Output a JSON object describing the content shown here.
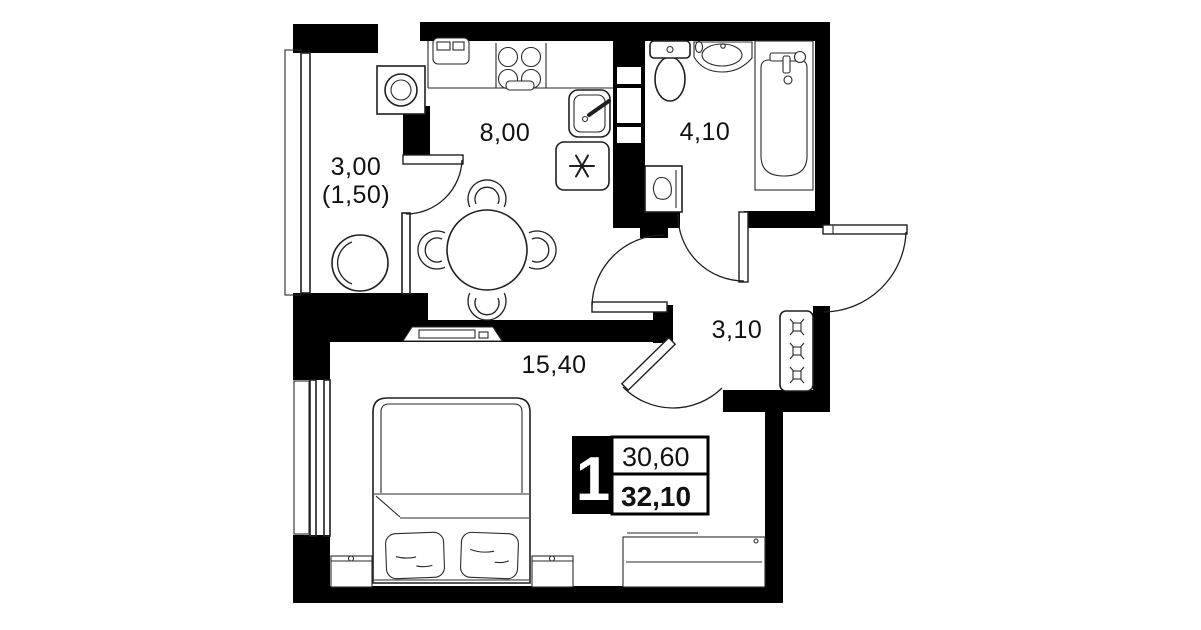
{
  "title": "apartment-floor-plan",
  "colors": {
    "wall": "#000000",
    "line": "#1f1f1f",
    "background": "#ffffff",
    "text": "#111111",
    "badge_bg": "#000000",
    "badge_text": "#ffffff"
  },
  "rooms": {
    "balcony": {
      "label_area": "3,00",
      "label_area_secondary": "(1,50)"
    },
    "kitchen": {
      "label_area": "8,00"
    },
    "bathroom": {
      "label_area": "4,10"
    },
    "hallway": {
      "label_area": "3,10"
    },
    "living_room": {
      "label_area": "15,40"
    }
  },
  "info_badge": {
    "room_count": "1",
    "living_area": "30,60",
    "total_area": "32,10"
  },
  "furniture_icons": [
    "washing-machine-icon",
    "balcony-chair-icon",
    "kitchen-appliance-icon",
    "cooktop-icon",
    "kitchen-sink-icon",
    "fridge-icon",
    "dining-table-icon",
    "chair-icon",
    "toilet-icon",
    "bathroom-sink-icon",
    "bathtub-icon",
    "bathroom-washer-icon",
    "wardrobe-icon",
    "tv-stand-icon",
    "bed-icon",
    "pillow-icon",
    "nightstand-icon",
    "dresser-icon",
    "door-icon",
    "window-icon",
    "ventilation-shaft-icon"
  ]
}
